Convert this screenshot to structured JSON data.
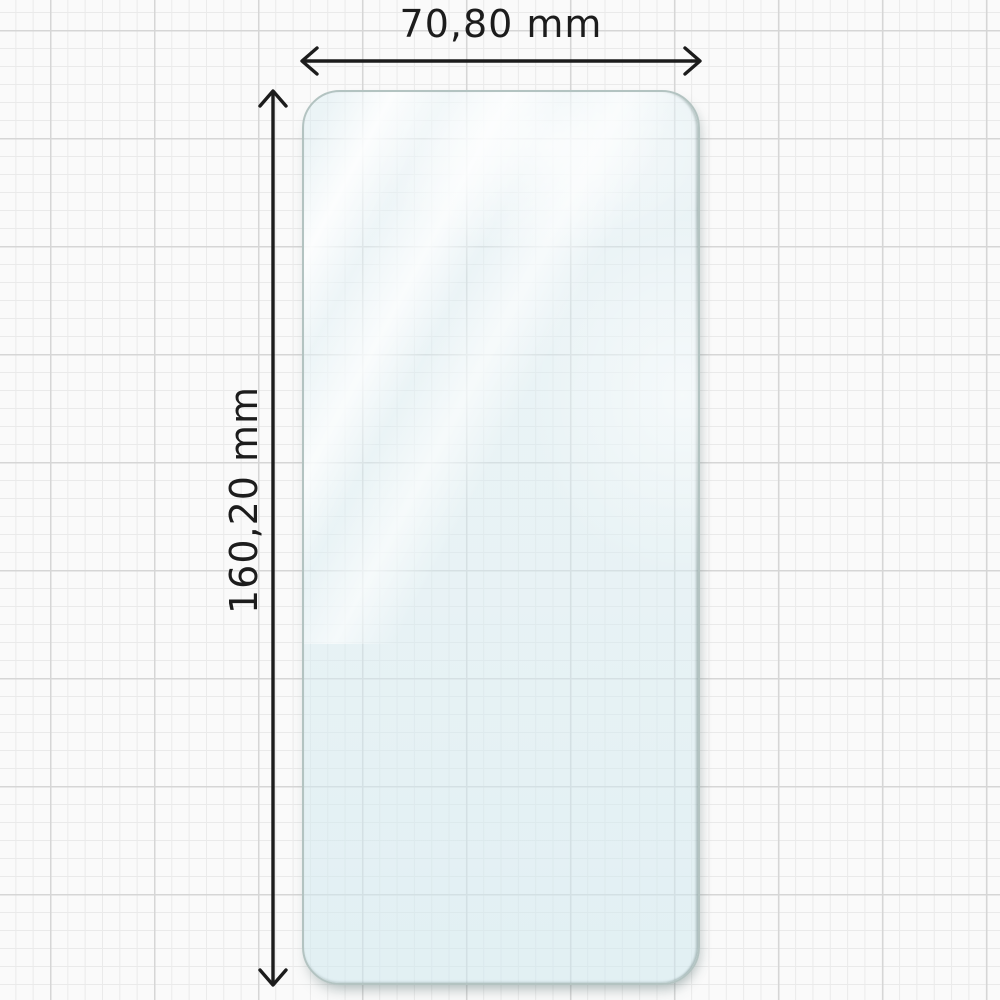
{
  "diagram": {
    "subject": "transparent-screen-protector-sheet",
    "width_dimension": {
      "label": "70,80 mm"
    },
    "height_dimension": {
      "label": "160,20 mm"
    }
  },
  "colors": {
    "background": "#fafafa",
    "grid_minor": "#eaeaea",
    "grid_major": "#d6d6d6",
    "arrow": "#1c1c1c",
    "label_text": "#1c1c1c",
    "protector_tint": "#d9ebf1",
    "protector_edge": "#b3c3c1",
    "protector_edge_dark": "#8d9f9d",
    "reflection": "#ffffff"
  }
}
